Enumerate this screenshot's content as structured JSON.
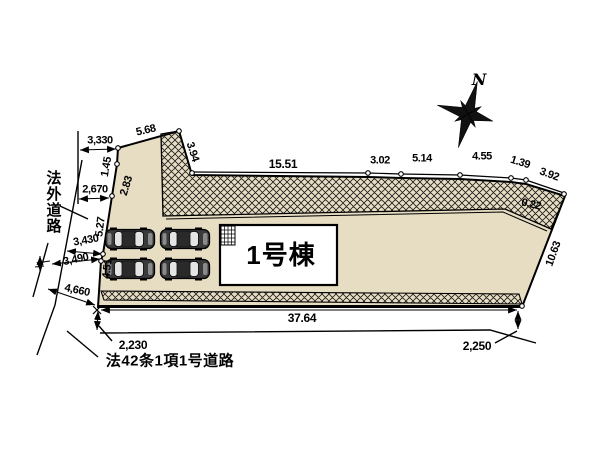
{
  "compass": {
    "north_label": "N"
  },
  "building": {
    "label": "1号棟"
  },
  "roads": {
    "left_label": "法外道路",
    "bottom_label": "法42条1項1号道路"
  },
  "dims": {
    "d3330": "3,330",
    "d5_68": "5.68",
    "d1_45": "1.45",
    "d2670": "2,670",
    "d2_83": "2.83",
    "d3_94": "3.94",
    "d15_51": "15.51",
    "d3_02": "3.02",
    "d5_14": "5.14",
    "d4_55": "4.55",
    "d1_39": "1.39",
    "d3_92": "3.92",
    "d0_22": "0.22",
    "d10_63": "10.63",
    "d5_27": "5.27",
    "d3430": "3,430",
    "d3490": "3,490",
    "d4_51": "4.51",
    "d4660": "4,660",
    "d37_64": "37.64",
    "d2230": "2,230",
    "d2250": "2,250"
  },
  "colors": {
    "site_fill": "#e7ddc3",
    "line": "#000000",
    "building_fill": "#ffffff",
    "car_body": "#3a3a3a"
  }
}
